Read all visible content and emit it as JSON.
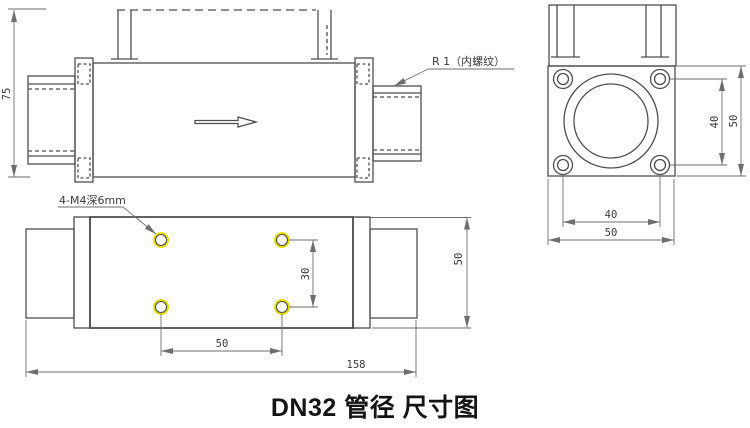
{
  "title": "DN32 管径 尺寸图",
  "colors": {
    "line": "#4f4f4f",
    "thin": "#6e6e6e",
    "text": "#3a3a3a",
    "title": "#141414",
    "hole_ring": "#e6db00"
  },
  "side_view": {
    "height_dim": "75",
    "thread_note": "R 1（内螺纹）"
  },
  "end_view": {
    "hole_spacing_vertical": "40",
    "overall_height": "50",
    "hole_spacing_horizontal": "40",
    "overall_width": "50"
  },
  "bottom_view": {
    "holes_note": "4-M4深6mm",
    "hole_spacing_vertical": "30",
    "overall_width": "50",
    "hole_spacing_horizontal": "50",
    "overall_length": "158"
  }
}
